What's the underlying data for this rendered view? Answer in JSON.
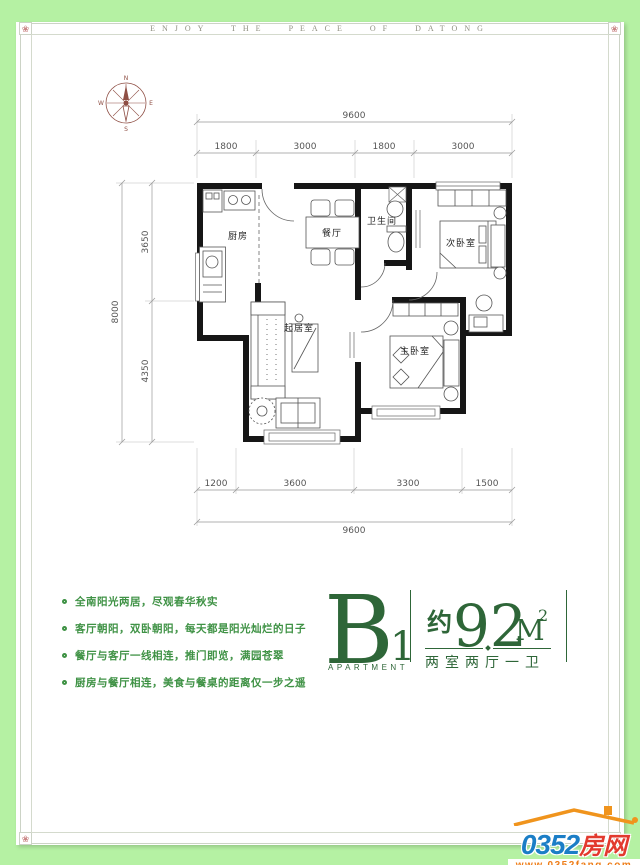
{
  "header": {
    "tagline": "ENJOY THE PEACE OF DATONG"
  },
  "compass": {
    "north": "N",
    "east": "E",
    "south": "S",
    "west": "W"
  },
  "floorplan": {
    "rooms": {
      "kitchen": "厨房",
      "dining": "餐厅",
      "bathroom": "卫生间",
      "bedroom2": "次卧室",
      "living": "起居室",
      "master": "主卧室"
    },
    "dims": {
      "top_total": "9600",
      "top_segments": [
        "1800",
        "3000",
        "1800",
        "3000"
      ],
      "bottom_segments": [
        "1200",
        "3600",
        "3300",
        "1500"
      ],
      "bottom_total": "9600",
      "left_total": "8000",
      "left_segments": [
        "3650",
        "4350"
      ]
    }
  },
  "features": {
    "items": [
      "全南阳光两居，尽观春华秋实",
      "客厅朝阳，双卧朝阳，每天都是阳光灿烂的日子",
      "餐厅与客厅一线相连，推门即览，满园苍翠",
      "厨房与餐厅相连，美食与餐桌的距离仅一步之遥"
    ]
  },
  "unit": {
    "block_letter": "B",
    "block_number": "1",
    "block_caption": "APARTMENT",
    "area_prefix": "约",
    "area_value": "92",
    "area_unit": "M",
    "area_exponent": "2",
    "layout": "两室两厅一卫"
  },
  "logo": {
    "number": "0352",
    "name": "房网",
    "url": "www.0352fang.com"
  },
  "ornament": {
    "corner_flower": "❀"
  },
  "colors": {
    "page_bg": "#b5f1a3",
    "accent_green": "#2e6638",
    "feature_green": "#3f9245",
    "wall_black": "#161616",
    "logo_blue": "#1b7ec6",
    "logo_red": "#e23a2e",
    "logo_orange": "#f0941d"
  }
}
